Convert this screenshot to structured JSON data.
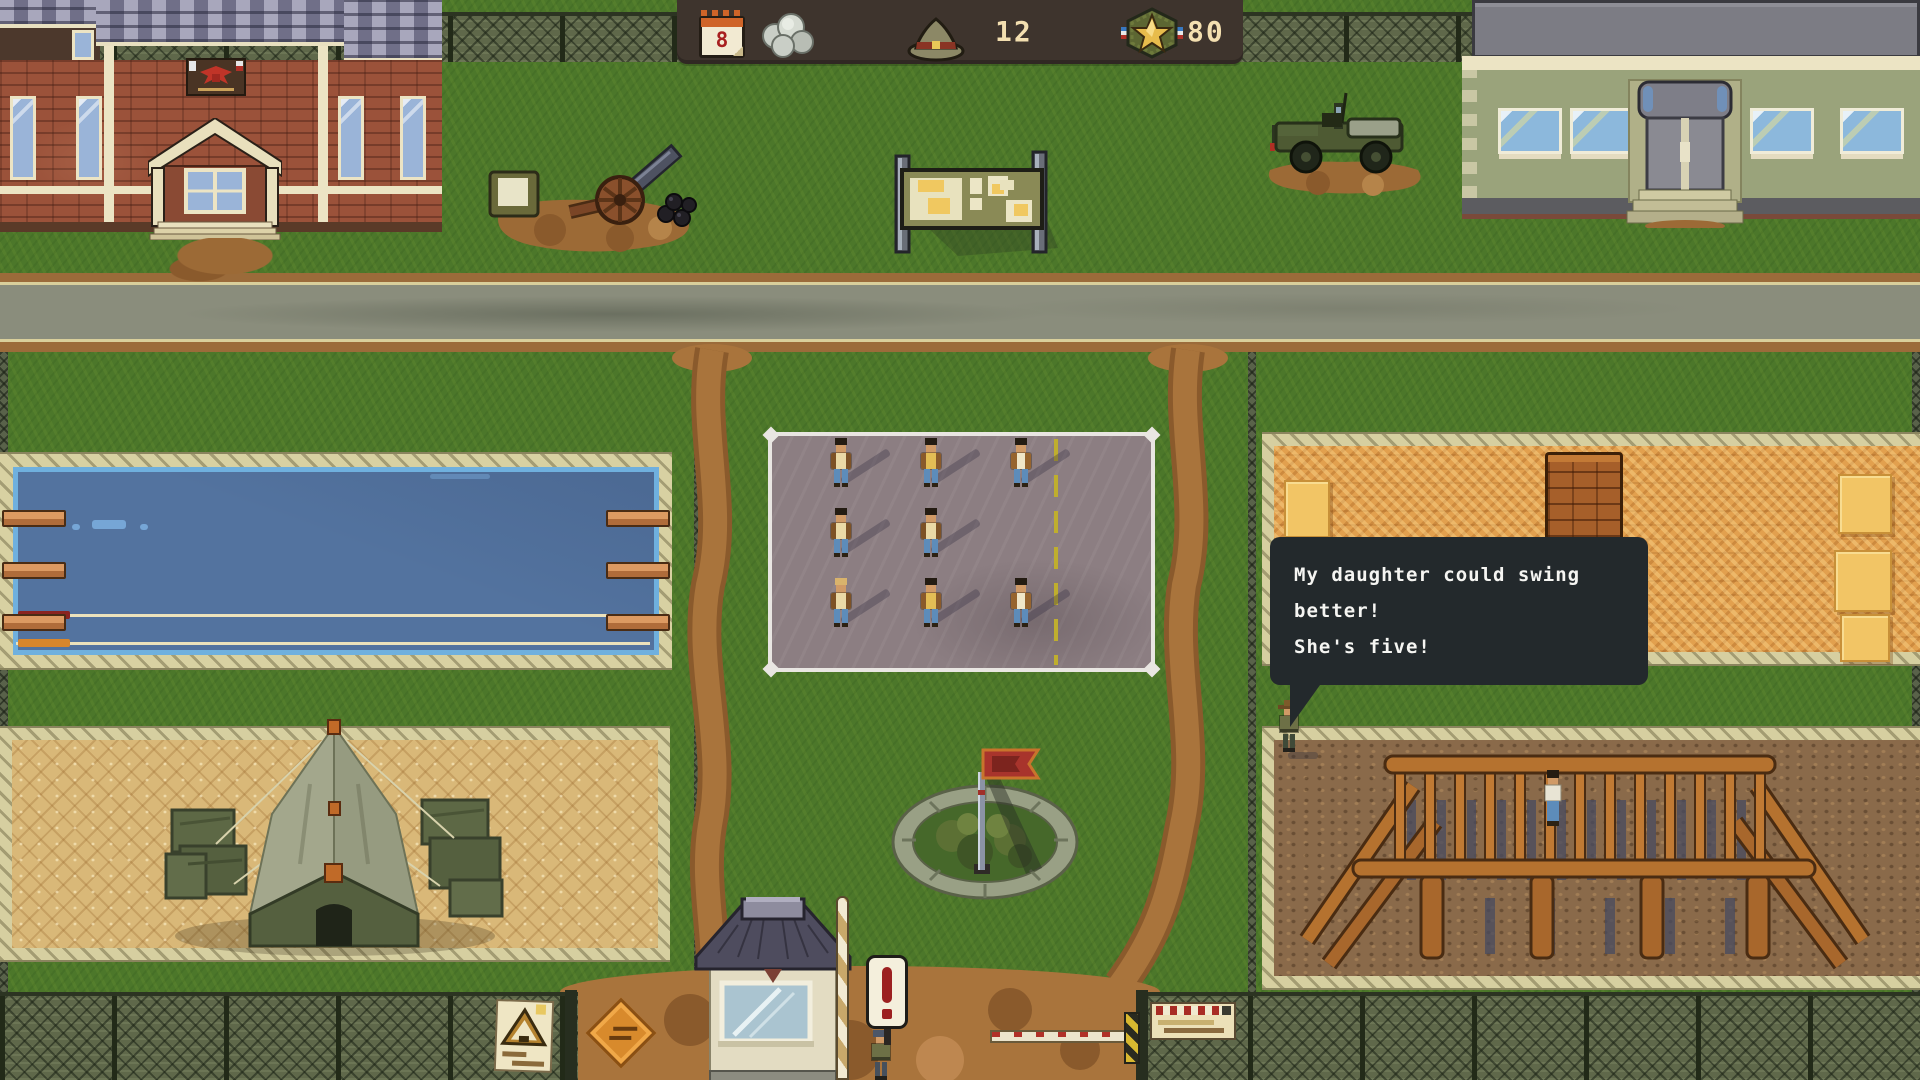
{
  "hud": {
    "calendar_day": "8",
    "hat_stat_value": "12",
    "star_stat_value": "80"
  },
  "speech": {
    "line1": "My daughter could swing better!",
    "line2": "She's five!"
  },
  "colors": {
    "grass": "#4c772a",
    "asphalt": "#8a8d7c",
    "dirt": "#a9743c",
    "water": "#53739f",
    "sand": "#d9b878",
    "parade_asphalt": "#8c7e82",
    "mat_orange": "#e2a04e",
    "hud_bg": "#3e342d",
    "hud_text": "#f3dfb0",
    "bubble_bg": "#23292c",
    "bubble_text": "#f5f5f2"
  }
}
